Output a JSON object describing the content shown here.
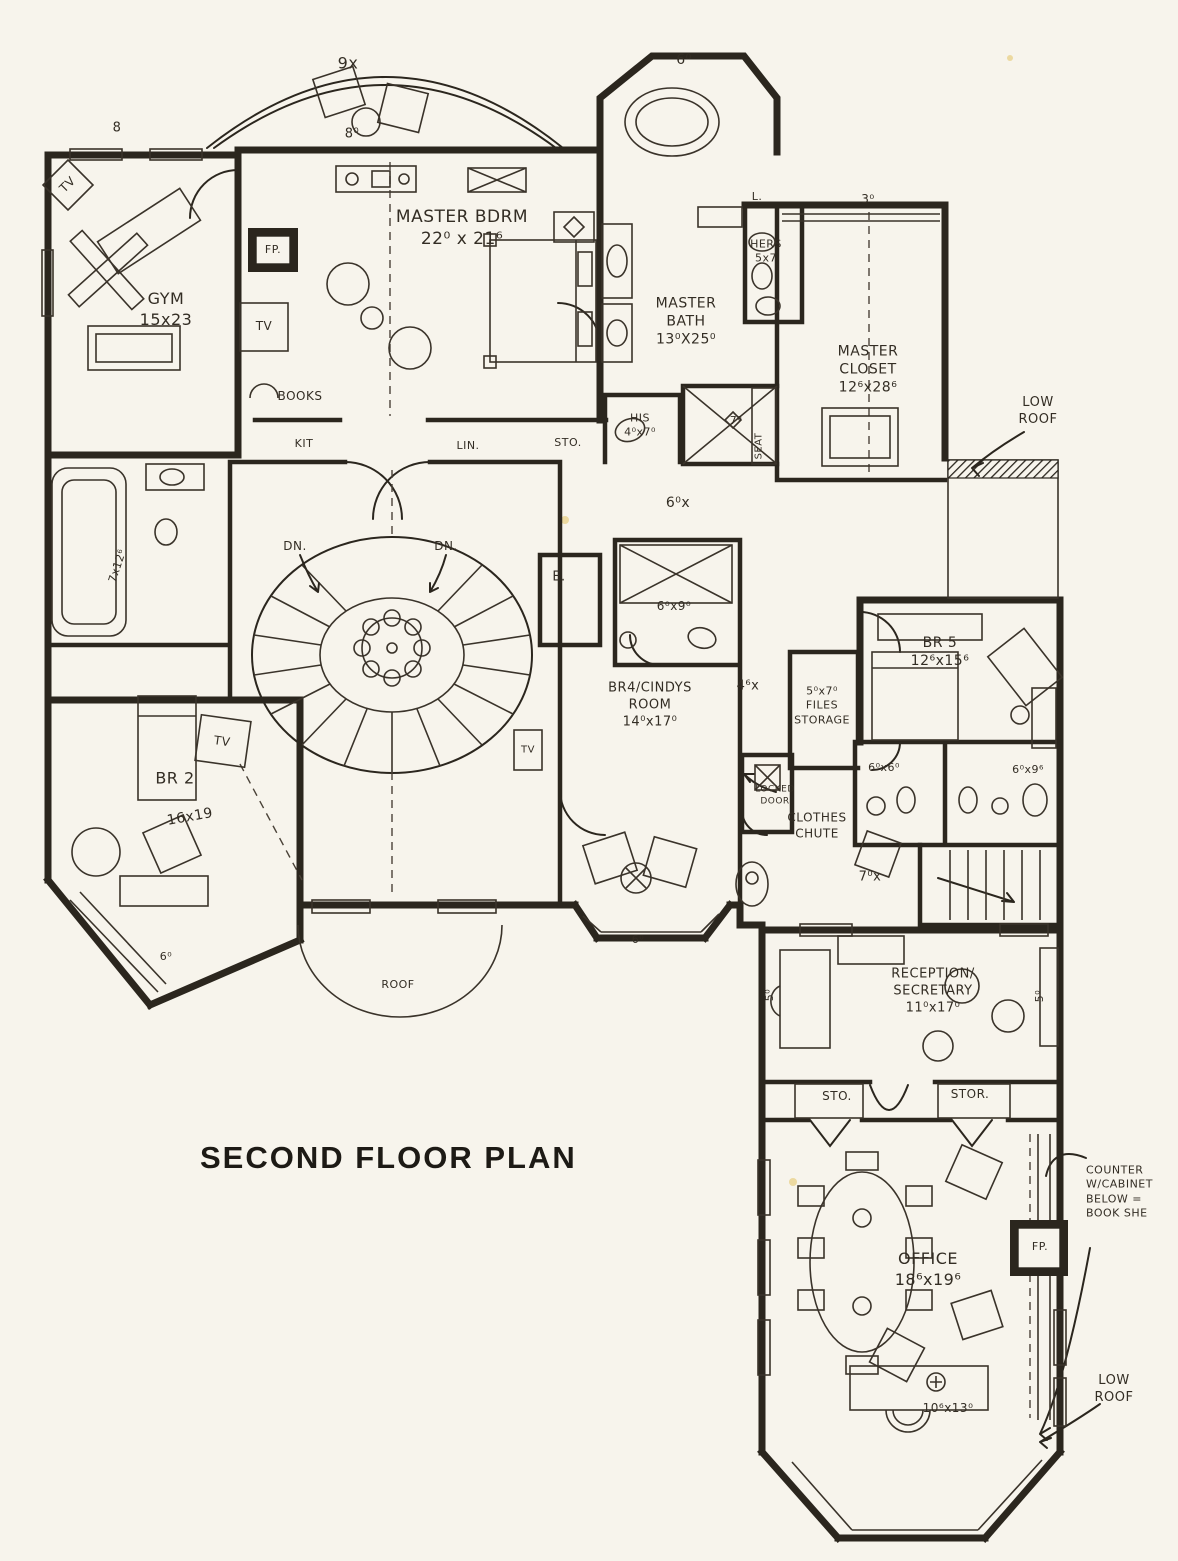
{
  "title": "SECOND FLOOR PLAN",
  "colors": {
    "ink": "#2b261e",
    "paper": "#f7f4ec"
  },
  "labels": [
    {
      "id": "dim-top-left-8",
      "text": "8",
      "x": 117,
      "y": 129,
      "size": 13
    },
    {
      "id": "balcony-dim-9x",
      "text": "9x",
      "x": 348,
      "y": 64,
      "size": 16
    },
    {
      "id": "balcony-dim-8",
      "text": "8⁰",
      "x": 352,
      "y": 135,
      "size": 13
    },
    {
      "id": "tower-dim-6",
      "text": "6⁰",
      "x": 684,
      "y": 60,
      "size": 14
    },
    {
      "id": "gym-tv",
      "text": "TV",
      "x": 68,
      "y": 185,
      "size": 12,
      "rot": -45
    },
    {
      "id": "room-master-bdrm",
      "text": "MASTER BDRM\n22⁰ x 21⁶",
      "x": 462,
      "y": 228,
      "size": 17
    },
    {
      "id": "room-gym",
      "text": "GYM\n15x23",
      "x": 166,
      "y": 310,
      "size": 16
    },
    {
      "id": "master-fp",
      "text": "FP.",
      "x": 273,
      "y": 250,
      "size": 11
    },
    {
      "id": "master-tv",
      "text": "TV",
      "x": 264,
      "y": 327,
      "size": 12
    },
    {
      "id": "books",
      "text": "BOOKS",
      "x": 300,
      "y": 397,
      "size": 12
    },
    {
      "id": "closet-kit",
      "text": "KIT",
      "x": 304,
      "y": 444,
      "size": 11
    },
    {
      "id": "closet-lin",
      "text": "LIN.",
      "x": 468,
      "y": 446,
      "size": 11
    },
    {
      "id": "closet-sto",
      "text": "STO.",
      "x": 568,
      "y": 443,
      "size": 11
    },
    {
      "id": "room-master-bath",
      "text": "MASTER\nBATH\n13⁰X25⁰",
      "x": 686,
      "y": 322,
      "size": 14
    },
    {
      "id": "hers-closet",
      "text": "HERS\n5x7",
      "x": 766,
      "y": 252,
      "size": 11
    },
    {
      "id": "closet-dim-3",
      "text": "3⁰",
      "x": 868,
      "y": 200,
      "size": 12
    },
    {
      "id": "label-l",
      "text": "L.",
      "x": 757,
      "y": 197,
      "size": 11
    },
    {
      "id": "room-master-closet",
      "text": "MASTER\nCLOSET\n12⁶x28⁶",
      "x": 868,
      "y": 370,
      "size": 14
    },
    {
      "id": "low-roof-top",
      "text": "LOW\nROOF",
      "x": 1038,
      "y": 412,
      "size": 13
    },
    {
      "id": "his-closet",
      "text": "HIS\n4⁰x7⁰",
      "x": 640,
      "y": 426,
      "size": 11
    },
    {
      "id": "shower-dim-7",
      "text": "7⁰",
      "x": 736,
      "y": 421,
      "size": 11
    },
    {
      "id": "shower-seat",
      "text": "SEAT",
      "x": 759,
      "y": 446,
      "size": 10,
      "rot": -90
    },
    {
      "id": "hall-dim-6x",
      "text": "6⁰x",
      "x": 678,
      "y": 503,
      "size": 14
    },
    {
      "id": "stairs-dn-left",
      "text": "DN.",
      "x": 295,
      "y": 547,
      "size": 12
    },
    {
      "id": "stairs-dn-right",
      "text": "DN.",
      "x": 446,
      "y": 547,
      "size": 12
    },
    {
      "id": "closet-e",
      "text": "E.",
      "x": 559,
      "y": 578,
      "size": 13
    },
    {
      "id": "bath-dim-6x9",
      "text": "6⁰x9⁰",
      "x": 674,
      "y": 607,
      "size": 12
    },
    {
      "id": "room-br5",
      "text": "BR 5\n12⁶x15⁶",
      "x": 940,
      "y": 652,
      "size": 14
    },
    {
      "id": "room-br4",
      "text": "BR4/CINDYS\nROOM\n14⁰x17⁰",
      "x": 650,
      "y": 706,
      "size": 13
    },
    {
      "id": "hall-dim-4x",
      "text": "4⁶x",
      "x": 748,
      "y": 687,
      "size": 13
    },
    {
      "id": "files-storage",
      "text": "5⁰x7⁰\nFILES\nSTORAGE",
      "x": 822,
      "y": 706,
      "size": 11
    },
    {
      "id": "left-bath-dim",
      "text": "7x12⁶",
      "x": 118,
      "y": 566,
      "size": 11,
      "rot": -72
    },
    {
      "id": "locked-door",
      "text": "LOCKED\nDOOR",
      "x": 775,
      "y": 796,
      "size": 9
    },
    {
      "id": "bath-dim-6x6",
      "text": "6⁰x6⁰",
      "x": 884,
      "y": 768,
      "size": 11
    },
    {
      "id": "bath-dim-6x9b",
      "text": "6⁰x9⁶",
      "x": 1028,
      "y": 770,
      "size": 11
    },
    {
      "id": "clothes-chute",
      "text": "CLOTHES\nCHUTE",
      "x": 817,
      "y": 826,
      "size": 12
    },
    {
      "id": "br2-tv",
      "text": "TV",
      "x": 222,
      "y": 742,
      "size": 12,
      "rot": 8
    },
    {
      "id": "br4-tv",
      "text": "TV",
      "x": 528,
      "y": 750,
      "size": 10
    },
    {
      "id": "room-br2",
      "text": "BR 2",
      "x": 175,
      "y": 779,
      "size": 16
    },
    {
      "id": "br2-dims",
      "text": "16x19",
      "x": 190,
      "y": 817,
      "size": 14,
      "rot": -10
    },
    {
      "id": "stairs-dim-7x",
      "text": "7⁰x",
      "x": 870,
      "y": 878,
      "size": 13
    },
    {
      "id": "bay-dim-6-left",
      "text": "6⁰",
      "x": 166,
      "y": 957,
      "size": 11
    },
    {
      "id": "bay-dim-6-mid",
      "text": "6⁰",
      "x": 638,
      "y": 940,
      "size": 11
    },
    {
      "id": "roof",
      "text": "ROOF",
      "x": 398,
      "y": 985,
      "size": 11
    },
    {
      "id": "reception-dim-5-left",
      "text": "5⁰",
      "x": 770,
      "y": 995,
      "size": 11,
      "rot": -90
    },
    {
      "id": "reception-dim-5-right",
      "text": "5⁰",
      "x": 1040,
      "y": 996,
      "size": 11,
      "rot": -90
    },
    {
      "id": "room-reception",
      "text": "RECEPTION/\nSECRETARY\n11⁰x17⁰",
      "x": 933,
      "y": 992,
      "size": 13
    },
    {
      "id": "office-sto",
      "text": "STO.",
      "x": 837,
      "y": 1097,
      "size": 12
    },
    {
      "id": "office-stor",
      "text": "STOR.",
      "x": 970,
      "y": 1095,
      "size": 12
    },
    {
      "id": "counter-note",
      "text": "COUNTER\nW/CABINET\nBELOW =\nBOOK SHE",
      "x": 1086,
      "y": 1192,
      "size": 11,
      "align": "left"
    },
    {
      "id": "room-office",
      "text": "OFFICE\n18⁶x19⁶",
      "x": 928,
      "y": 1270,
      "size": 16
    },
    {
      "id": "office-fp",
      "text": "FP.",
      "x": 1040,
      "y": 1247,
      "size": 11
    },
    {
      "id": "low-roof-bottom",
      "text": "LOW\nROOF",
      "x": 1114,
      "y": 1390,
      "size": 13
    },
    {
      "id": "office-desk-dim",
      "text": "10⁶x13⁰",
      "x": 948,
      "y": 1409,
      "size": 12
    }
  ]
}
